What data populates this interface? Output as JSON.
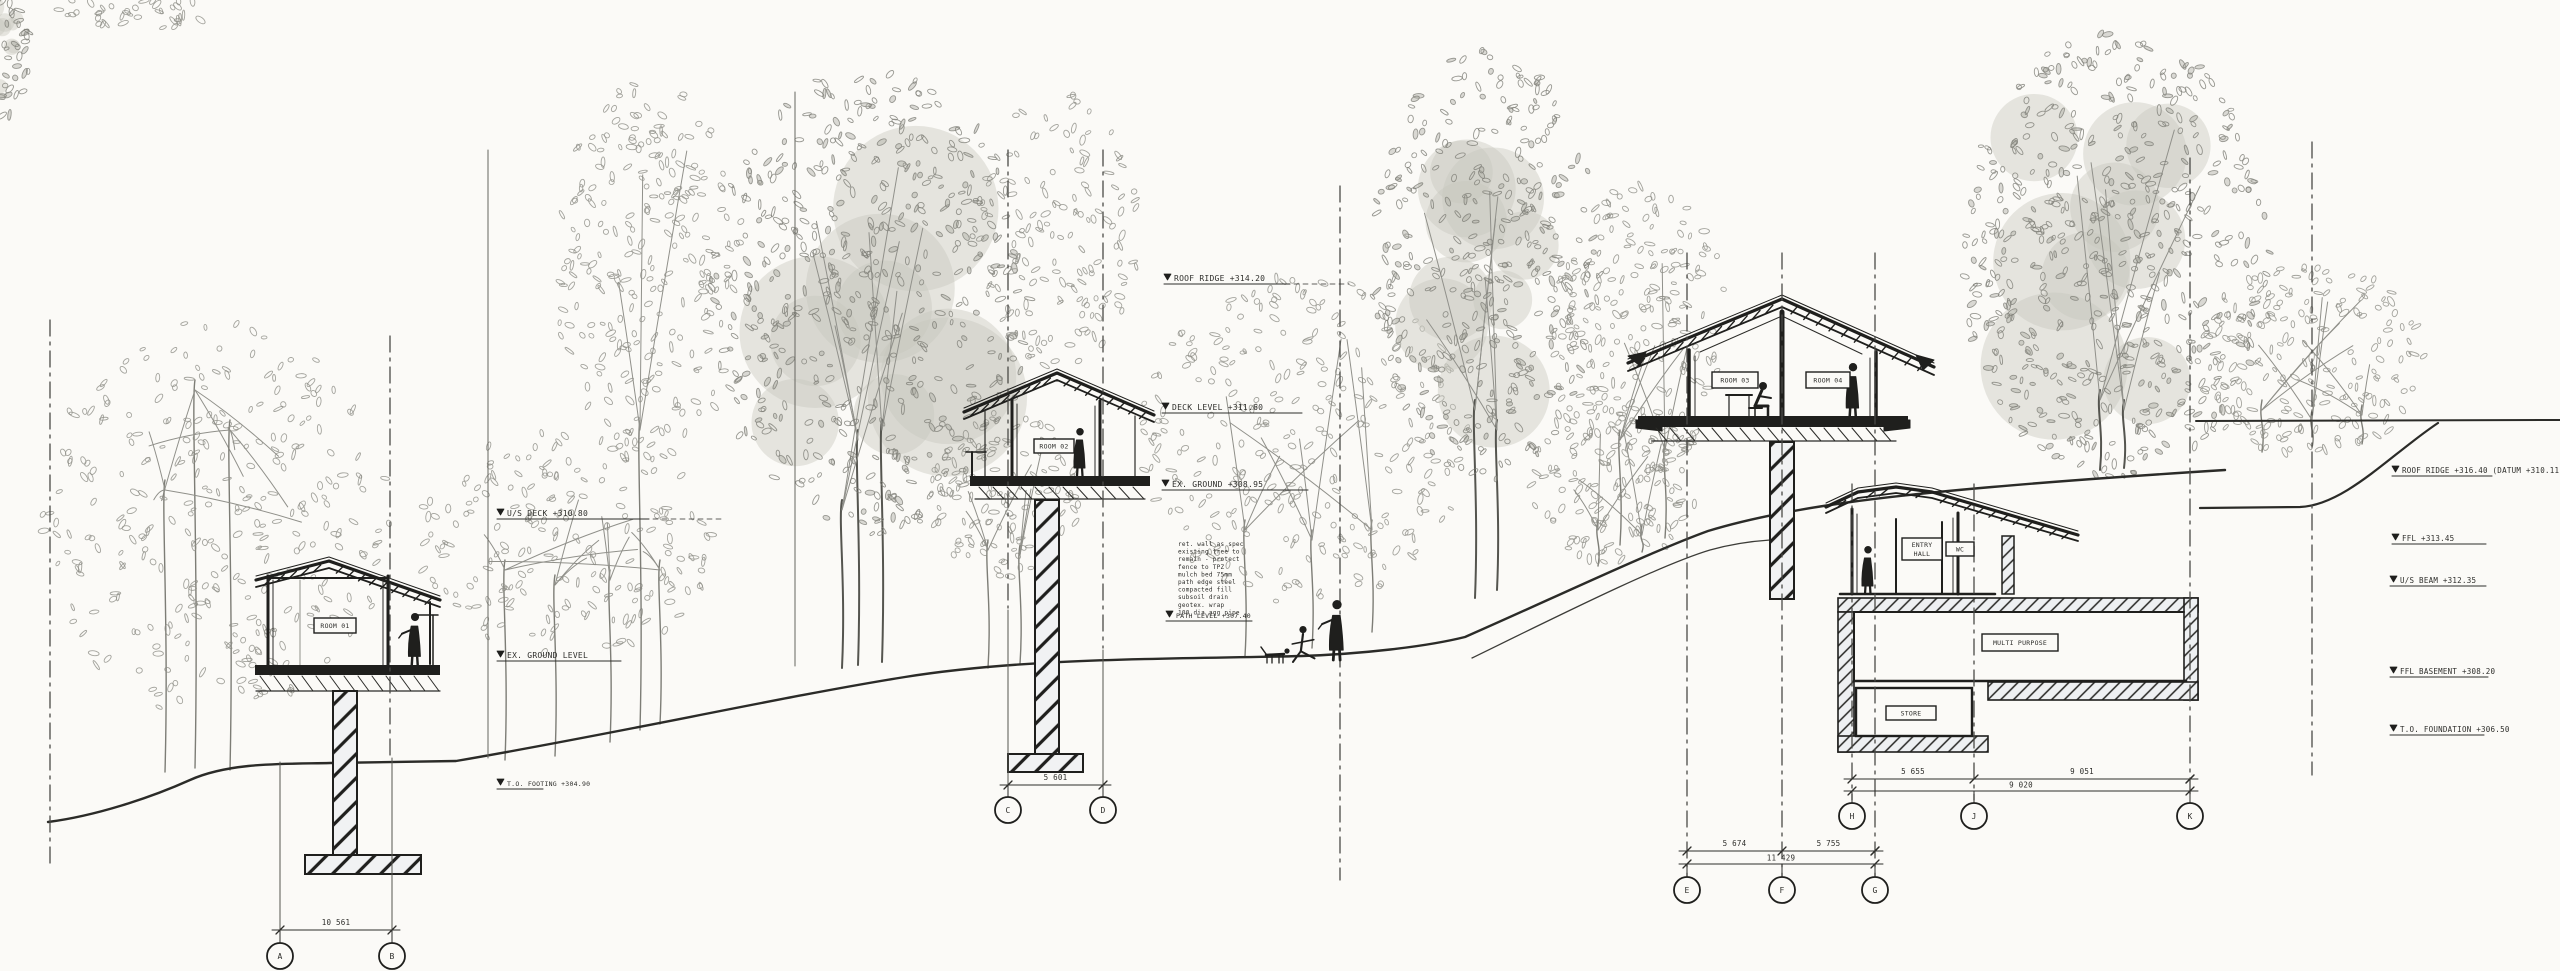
{
  "drawing": {
    "title": "site-section-with-elevated-cabins",
    "colors": {
      "paper": "#fbfaf7",
      "ink": "#1f1f1d",
      "line": "#2b2b28",
      "grid": "#4a4a46",
      "foliage_stroke": "#8f8f87",
      "foliage_dense": "#7f7f78",
      "foliage_fill": "#c6c6bd",
      "annotation": "#2e2e2b",
      "note": "#5a5a52",
      "trunk": "#7d7d76"
    }
  },
  "tags": [
    {
      "text": "ROOM 01"
    },
    {
      "text": "ROOM 02"
    },
    {
      "text": "ROOM 03"
    },
    {
      "text": "ROOM 04"
    },
    {
      "text": "ENTRY",
      "text2": "HALL"
    },
    {
      "text": "WC"
    },
    {
      "text": "MULTI PURPOSE"
    },
    {
      "text": "STORE"
    }
  ],
  "levels": [
    {
      "text": "U/S DECK  +310.80"
    },
    {
      "text": "EX. GROUND LEVEL"
    },
    {
      "text": "T.O. FOOTING +304.90"
    },
    {
      "text": "ROOF RIDGE  +314.20"
    },
    {
      "text": "DECK LEVEL  +311.60"
    },
    {
      "text": "EX. GROUND  +308.95"
    },
    {
      "text": "PATH LEVEL +307.40"
    },
    {
      "text": "ROOF RIDGE  +316.40   (DATUM +310.11)"
    },
    {
      "text": "FFL  +313.45"
    },
    {
      "text": "U/S BEAM  +312.35"
    },
    {
      "text": "FFL BASEMENT  +308.20"
    },
    {
      "text": "T.O. FOUNDATION  +306.50"
    }
  ],
  "notes": {
    "lines": [
      "ret. wall as spec",
      "existing tree to",
      "remain - protect",
      "fence to TPZ",
      "mulch bed 75mm",
      "path edge steel",
      "compacted fill",
      "subsoil drain",
      "geotex. wrap",
      "100 dia agg pipe"
    ]
  },
  "dims": [
    {
      "label": "10 561",
      "bubbles": [
        {
          "label": "A"
        },
        {
          "label": "B"
        }
      ]
    },
    {
      "label": "5 601",
      "bubbles": [
        {
          "label": "C"
        },
        {
          "label": "D"
        }
      ]
    },
    {
      "segs": [
        {
          "label": "5 674"
        },
        {
          "label": "5 755"
        }
      ],
      "label2": "11 429",
      "bubbles": [
        {
          "label": "E"
        },
        {
          "label": "F"
        },
        {
          "label": "G"
        }
      ]
    },
    {
      "segs": [
        {
          "label": "5 655"
        },
        {
          "label": "9 051"
        }
      ],
      "label2": "9 020",
      "bubbles": [
        {
          "label": "H"
        },
        {
          "label": "J"
        },
        {
          "label": "K"
        }
      ]
    }
  ],
  "scene": {
    "trees": [
      {
        "cx": 6,
        "cy": 45,
        "rx": 24,
        "ry": 72,
        "n": 60,
        "dense": 1,
        "trunks": []
      },
      {
        "cx": 135,
        "cy": 10,
        "rx": 78,
        "ry": 20,
        "n": 45,
        "dense": 0,
        "trunks": []
      },
      {
        "cx": 215,
        "cy": 520,
        "rx": 175,
        "ry": 200,
        "n": 330,
        "dense": 0,
        "trunks": [
          {
            "x": 195,
            "y1": 380,
            "y2": 768
          },
          {
            "x": 230,
            "y1": 420,
            "y2": 770
          },
          {
            "x": 165,
            "y1": 480,
            "y2": 772
          }
        ]
      },
      {
        "cx": 565,
        "cy": 545,
        "rx": 150,
        "ry": 115,
        "n": 200,
        "dense": 0,
        "trunks": [
          {
            "x": 505,
            "y1": 560,
            "y2": 760
          },
          {
            "x": 555,
            "y1": 575,
            "y2": 756
          },
          {
            "x": 610,
            "y1": 570,
            "y2": 742
          },
          {
            "x": 660,
            "y1": 560,
            "y2": 724
          }
        ]
      },
      {
        "cx": 650,
        "cy": 270,
        "rx": 95,
        "ry": 190,
        "n": 260,
        "dense": 0,
        "trunks": [
          {
            "x": 640,
            "y1": 420,
            "y2": 730
          }
        ]
      },
      {
        "cx": 870,
        "cy": 300,
        "rx": 160,
        "ry": 235,
        "n": 520,
        "dense": 1,
        "trunks": [
          {
            "x": 858,
            "y1": 430,
            "y2": 665
          },
          {
            "x": 882,
            "y1": 420,
            "y2": 662
          },
          {
            "x": 842,
            "y1": 500,
            "y2": 668
          }
        ]
      },
      {
        "cx": 1060,
        "cy": 230,
        "rx": 80,
        "ry": 140,
        "n": 150,
        "dense": 0,
        "trunks": []
      },
      {
        "cx": 1005,
        "cy": 495,
        "rx": 75,
        "ry": 85,
        "n": 130,
        "dense": 0,
        "trunks": [
          {
            "x": 988,
            "y1": 540,
            "y2": 668
          },
          {
            "x": 1020,
            "y1": 545,
            "y2": 664
          }
        ]
      },
      {
        "cx": 1305,
        "cy": 440,
        "rx": 165,
        "ry": 165,
        "n": 300,
        "dense": 0,
        "trunks": [
          {
            "x": 1245,
            "y1": 520,
            "y2": 656
          },
          {
            "x": 1312,
            "y1": 530,
            "y2": 648
          },
          {
            "x": 1372,
            "y1": 520,
            "y2": 632
          }
        ]
      },
      {
        "cx": 1485,
        "cy": 265,
        "rx": 115,
        "ry": 215,
        "n": 380,
        "dense": 1,
        "trunks": [
          {
            "x": 1475,
            "y1": 400,
            "y2": 598
          },
          {
            "x": 1497,
            "y1": 420,
            "y2": 590
          }
        ]
      },
      {
        "cx": 1640,
        "cy": 330,
        "rx": 90,
        "ry": 150,
        "n": 220,
        "dense": 0,
        "trunks": [
          {
            "x": 1620,
            "y1": 430,
            "y2": 545
          },
          {
            "x": 1665,
            "y1": 440,
            "y2": 538
          }
        ]
      },
      {
        "cx": 1615,
        "cy": 480,
        "rx": 85,
        "ry": 85,
        "n": 140,
        "dense": 0,
        "trunks": [
          {
            "x": 1598,
            "y1": 520,
            "y2": 566
          },
          {
            "x": 1642,
            "y1": 525,
            "y2": 552
          }
        ]
      },
      {
        "cx": 2115,
        "cy": 255,
        "rx": 155,
        "ry": 225,
        "n": 560,
        "dense": 1,
        "trunks": [
          {
            "x": 2100,
            "y1": 390,
            "y2": 470
          },
          {
            "x": 2124,
            "y1": 400,
            "y2": 468
          }
        ]
      },
      {
        "cx": 2310,
        "cy": 360,
        "rx": 115,
        "ry": 100,
        "n": 210,
        "dense": 0,
        "trunks": [
          {
            "x": 2262,
            "y1": 400,
            "y2": 452
          },
          {
            "x": 2312,
            "y1": 410,
            "y2": 448
          },
          {
            "x": 2362,
            "y1": 405,
            "y2": 444
          }
        ]
      }
    ]
  }
}
